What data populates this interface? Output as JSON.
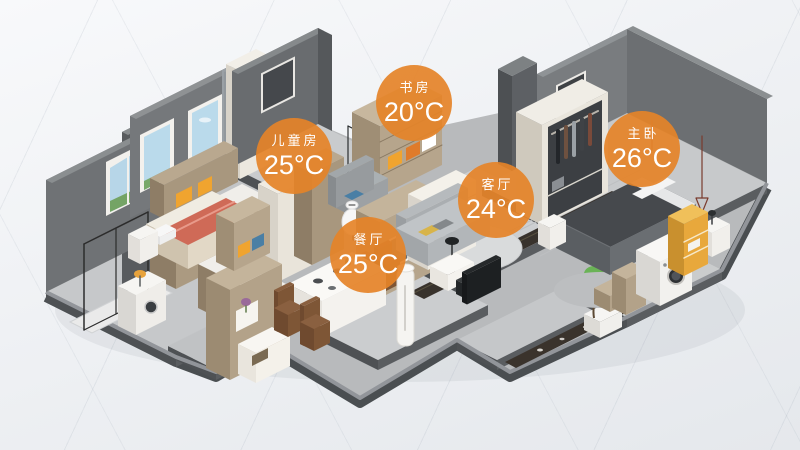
{
  "rooms": [
    {
      "id": "children-room",
      "label": "儿童房",
      "temperature": "25°C"
    },
    {
      "id": "study",
      "label": "书房",
      "temperature": "20°C"
    },
    {
      "id": "living-room",
      "label": "客厅",
      "temperature": "24°C"
    },
    {
      "id": "dining-room",
      "label": "餐厅",
      "temperature": "25°C"
    },
    {
      "id": "master-bedroom",
      "label": "主卧",
      "temperature": "26°C"
    }
  ],
  "colors": {
    "badge_background": "#E5832D",
    "badge_text": "#FFFFFF",
    "wall_gray": "#6F7275",
    "floor_gray": "#C7C9CB",
    "wood": "#B3A289",
    "accent_yellow": "#F0A42F"
  }
}
